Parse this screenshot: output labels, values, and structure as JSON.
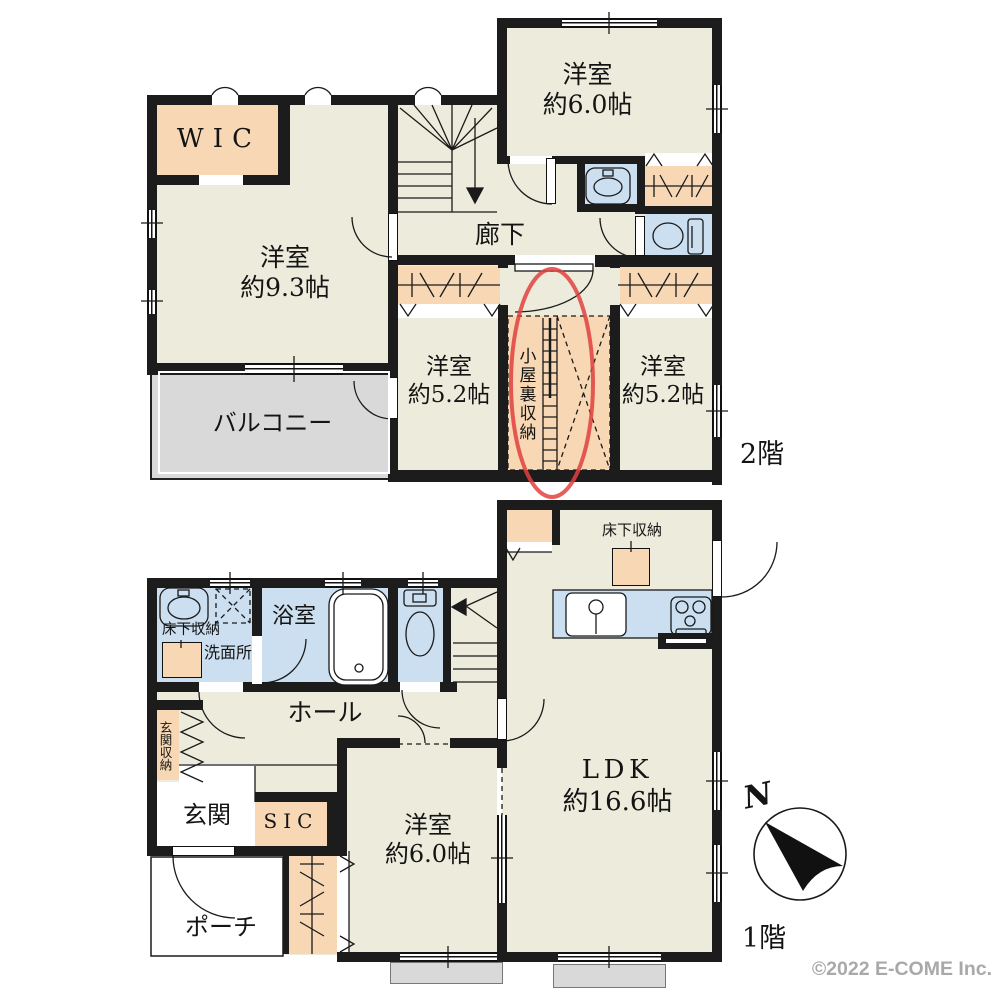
{
  "floor2": {
    "label": "2階",
    "rooms": {
      "wic": {
        "label": "WIC"
      },
      "bedroom_93": {
        "label": "洋室",
        "size": "約9.3帖"
      },
      "bedroom_60": {
        "label": "洋室",
        "size": "約6.0帖"
      },
      "bedroom_52_left": {
        "label": "洋室",
        "size": "約5.2帖"
      },
      "bedroom_52_right": {
        "label": "洋室",
        "size": "約5.2帖"
      },
      "corridor": {
        "label": "廊下"
      },
      "attic_storage": {
        "label": "小屋裏収納"
      },
      "balcony": {
        "label": "バルコニー"
      }
    }
  },
  "floor1": {
    "label": "1階",
    "rooms": {
      "ldk": {
        "label": "LDK",
        "size": "約16.6帖"
      },
      "bedroom_60": {
        "label": "洋室",
        "size": "約6.0帖"
      },
      "hall": {
        "label": "ホール"
      },
      "bathroom": {
        "label": "浴室"
      },
      "washroom": {
        "label": "洗面所"
      },
      "underfloor_storage_washroom": {
        "label": "床下収納"
      },
      "underfloor_storage_kitchen": {
        "label": "床下収納"
      },
      "entrance": {
        "label": "玄関"
      },
      "entrance_storage": {
        "label": "玄関収納"
      },
      "shoe_closet": {
        "label": "SIC"
      },
      "porch": {
        "label": "ポーチ"
      }
    }
  },
  "compass": {
    "north_label": "N"
  },
  "footer": {
    "copyright": "©2022 E-COME Inc."
  },
  "colors": {
    "wall": "#1c1c1c",
    "floor": "#edecdc",
    "storage": "#f8d8b4",
    "water": "#cbdff1",
    "balcony": "#d9d9d9",
    "annotation_red": "#e0413f"
  }
}
